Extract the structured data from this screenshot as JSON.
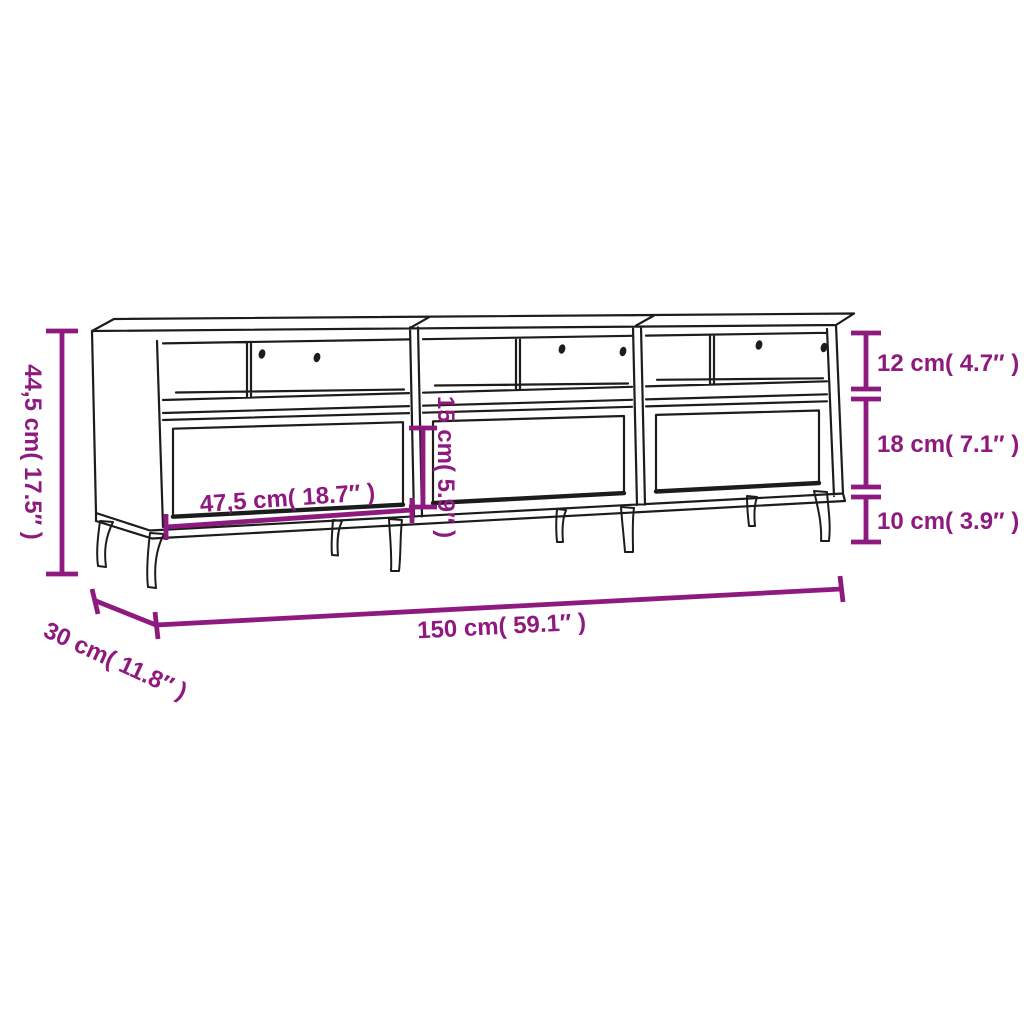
{
  "figure": {
    "title": "TV stand dimension diagram",
    "description": "Black outline drawing of a TV stand with three open compartments (each with a divider and two cable holes), three drawers and tapered splayed legs, annotated with purple dimension lines",
    "colors": {
      "dimension_annotation": "#8E1A80",
      "drawing_outline": "#1C1C1C",
      "background": "#FFFFFF"
    },
    "dimensions": {
      "overall_height": "44,5 cm( 17.5″ )",
      "top_compartment_height": "12 cm( 4.7″ )",
      "drawer_section_height": "18 cm( 7.1″ )",
      "leg_height": "10 cm( 3.9″ )",
      "drawer_front_height": "15 cm( 5.9″ )",
      "compartment_width": "47,5 cm( 18.7″ )",
      "overall_width": "150 cm( 59.1″ )",
      "depth": "30 cm( 11.8″ )"
    }
  }
}
